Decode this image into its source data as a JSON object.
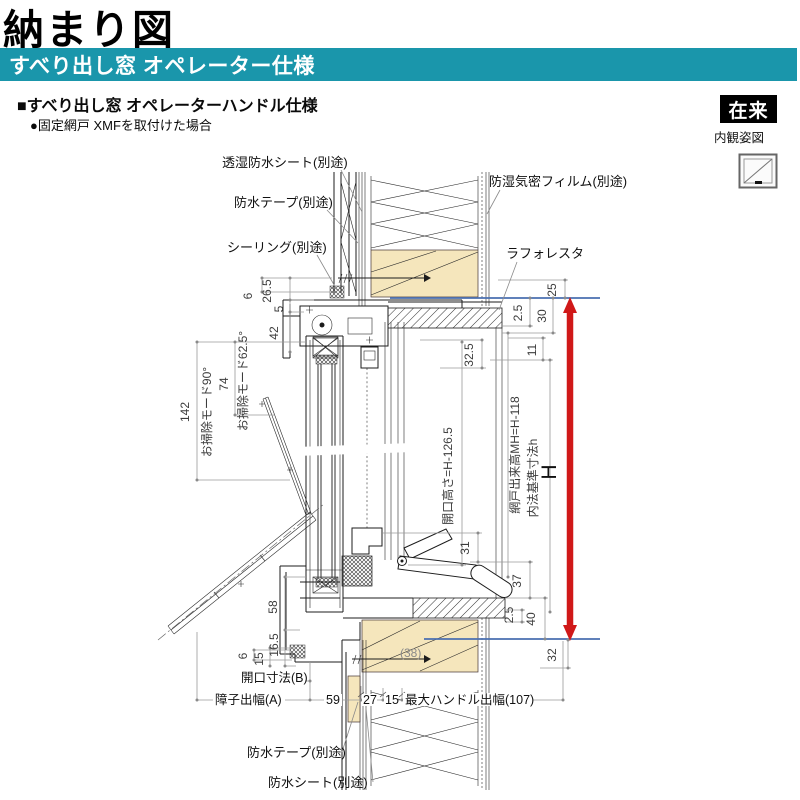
{
  "header": {
    "title": "納まり図",
    "banner": "すべり出し窓 オペレーター仕様",
    "subtitle": "■すべり出し窓 オペレーターハンドル仕様",
    "note": "●固定網戸 XMFを取付けた場合",
    "badge": "在来",
    "badge_caption": "内観姿図"
  },
  "callouts": {
    "sheet_top": "透湿防水シート(別途)",
    "tape_top": "防水テープ(別途)",
    "sealing": "シーリング(別途)",
    "film": "防湿気密フィルム(別途)",
    "laforesta": "ラフォレスタ",
    "tape_bottom": "防水テープ(別途)",
    "sheet_bottom": "防水シート(別途)"
  },
  "dims": {
    "top_left": {
      "d6": "6",
      "d26_5": "26.5",
      "d5": "5",
      "d42": "42"
    },
    "cleaning": {
      "d142": "142",
      "mode90": "お掃除モード90°",
      "d74": "74",
      "mode62": "お掃除モード62.5°"
    },
    "bottom_left": {
      "d58": "58",
      "d16_5": "16.5",
      "d15": "15",
      "d6": "6"
    },
    "center": {
      "opening_height": "開口高さ=H-126.5",
      "d32_5": "32.5",
      "d31": "31",
      "wood": "(38)"
    },
    "right": {
      "d25": "25",
      "d2_5a": "2.5",
      "d30": "30",
      "d11": "11",
      "screen_height": "網戸出来高MH=H-118",
      "inner_ref": "内法基準寸法h",
      "H": "H",
      "d37": "37",
      "d2_5b": "2.5",
      "d40": "40",
      "d32": "32"
    },
    "bottom": {
      "opening_b": "開口寸法(B)",
      "sash_a": "障子出幅(A)",
      "d59": "59",
      "d27": "27",
      "d15": "15",
      "handle_max": "最大ハンドル出幅(107)"
    }
  },
  "colors": {
    "banner": "#1a96ab",
    "wood": "#f5e6bc",
    "blue_line": "#4a6fb0",
    "red_arrow": "#d01818"
  }
}
